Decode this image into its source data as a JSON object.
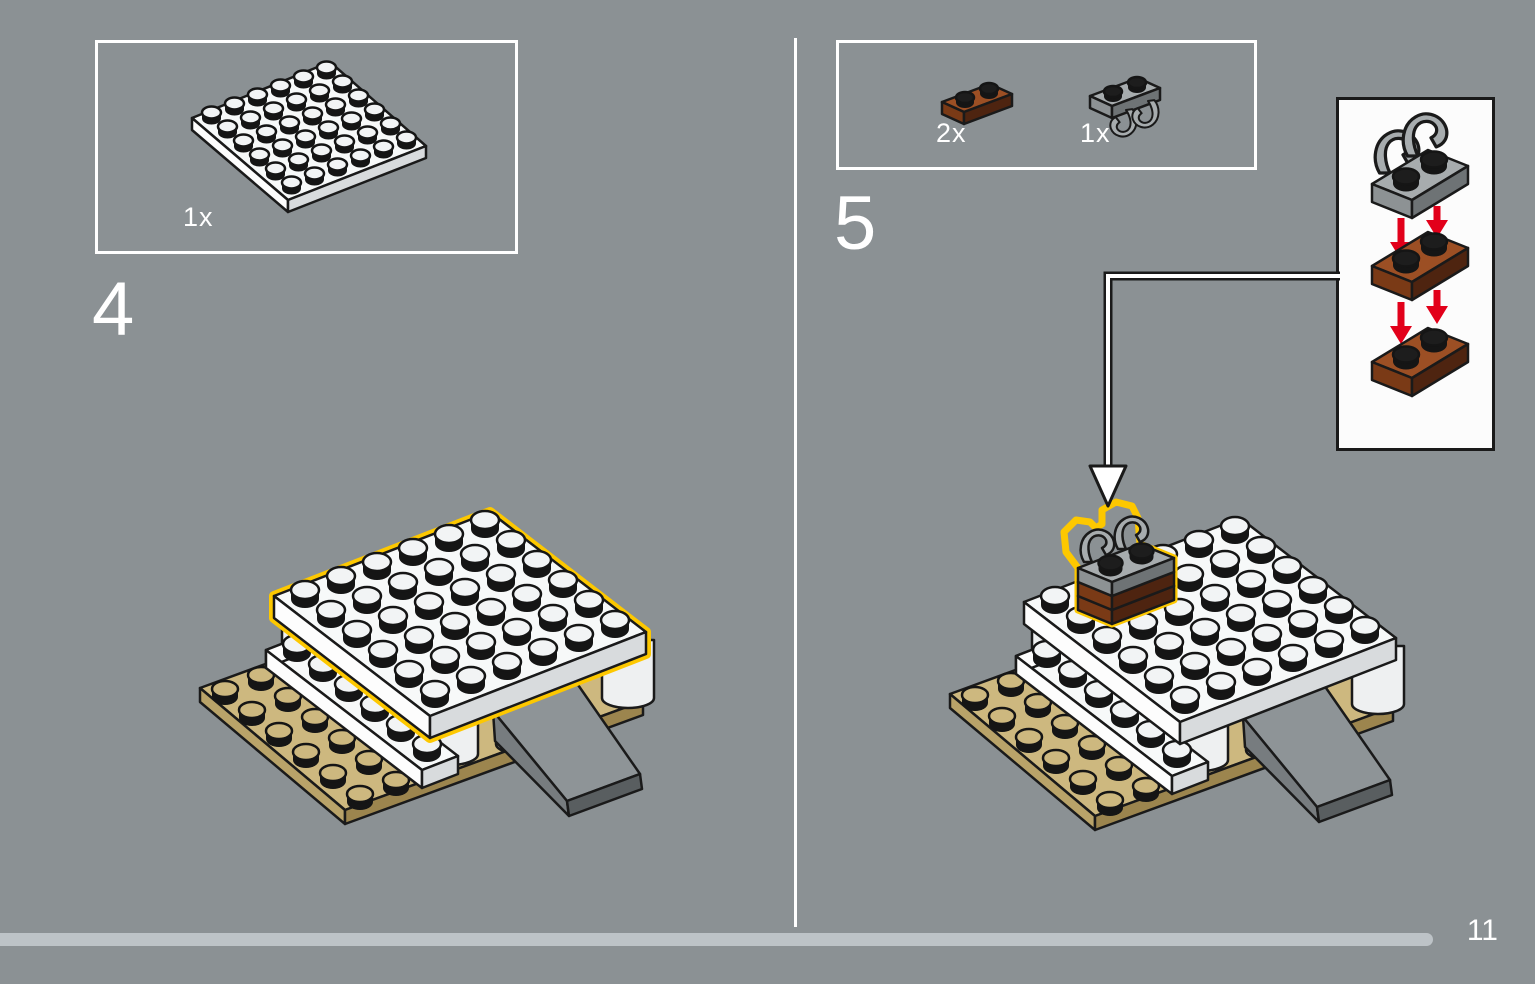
{
  "page": {
    "number": "11"
  },
  "steps": [
    {
      "number": "4",
      "parts": [
        {
          "name": "white-plate-6x6",
          "count": "1x"
        }
      ]
    },
    {
      "number": "5",
      "parts": [
        {
          "name": "reddish-brown-plate-1x2",
          "count": "2x"
        },
        {
          "name": "light-gray-plate-1x2-with-clips",
          "count": "1x"
        }
      ]
    }
  ],
  "callout": {
    "content": "stacking-order-clip-plate-onto-two-brown-plates"
  },
  "colors": {
    "bg": "#8b9194",
    "panel_border": "#ffffff",
    "callout_bg": "#fcfcfc",
    "line": "#1a1a1a",
    "text": "#ffffff",
    "progress": "#bdc3c7",
    "highlight": "#fdc800",
    "arrow_red": "#e2001a",
    "white_top": "#f7f9f9",
    "white_side_l": "#fdfdfd",
    "white_side_r": "#d8dbdd",
    "white_stud": "#f2f4f5",
    "barrel": "#eef0f1",
    "tan_top": "#cdb87f",
    "tan_side_l": "#b9a369",
    "tan_side_r": "#9c854e",
    "tan_stud": "#cdb87f",
    "brown_top": "#9c4f24",
    "brown_side_l": "#7a3a16",
    "brown_side_r": "#4e2410",
    "gray_top": "#a7acae",
    "gray_side_l": "#8d9294",
    "gray_side_r": "#6e7375",
    "ramp_top": "#8e9497",
    "ramp_side": "#777c7f",
    "ramp_end": "#595e60",
    "stud_dark": "#1d1d1d"
  }
}
